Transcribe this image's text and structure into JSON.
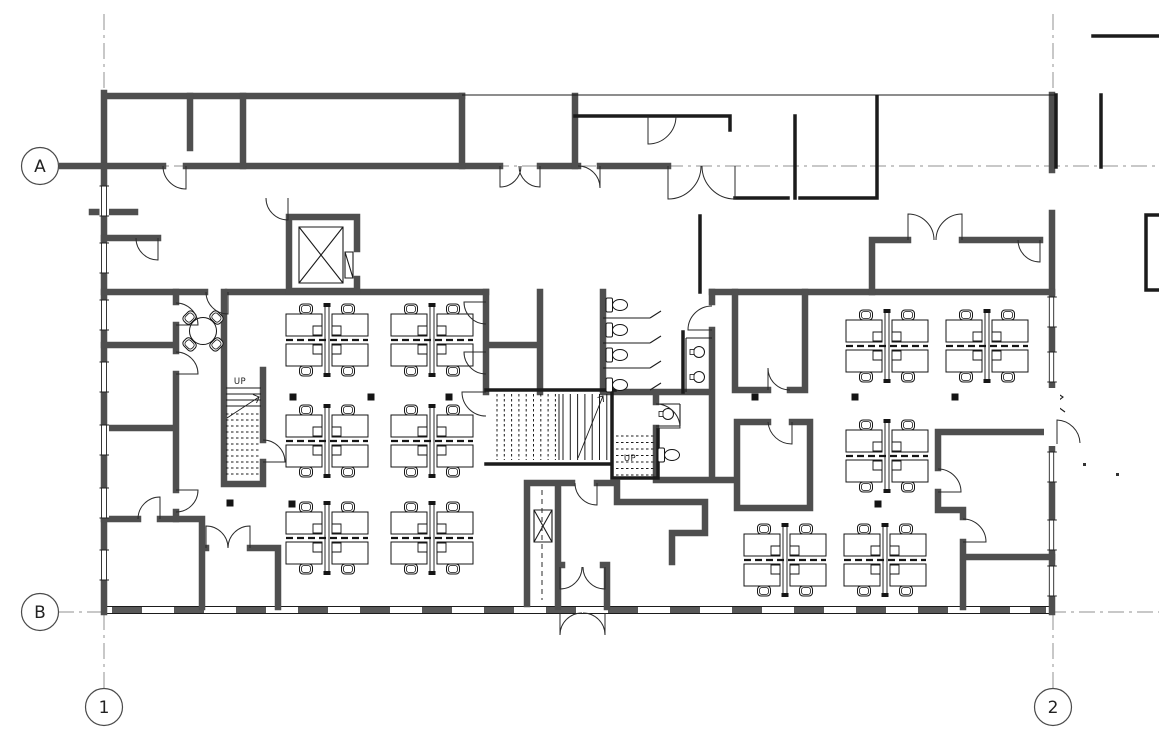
{
  "document": {
    "type": "architectural floor plan",
    "description": "Office floor plan: open-plan 4-person workstation pods, perimeter private offices, central core with two stairs, elevator, restrooms, entry vestibule, curtain-wall facade"
  },
  "grid": {
    "row_a": "A",
    "row_b": "B",
    "col_1": "1",
    "col_2": "2"
  },
  "labels": {
    "stair_west_up": "UP",
    "stair_core_up": "UP"
  },
  "furniture": {
    "workstation_pods": 11,
    "meeting_table_seats": 4,
    "toilets": 5,
    "sinks": 3
  },
  "colors": {
    "background": "#ffffff",
    "wall": "#4f4f4f",
    "structure": "#1b1b1b",
    "detail": "#2a2a2a",
    "grid_line": "#909090",
    "hatch": "#585858",
    "text": "#222222"
  }
}
